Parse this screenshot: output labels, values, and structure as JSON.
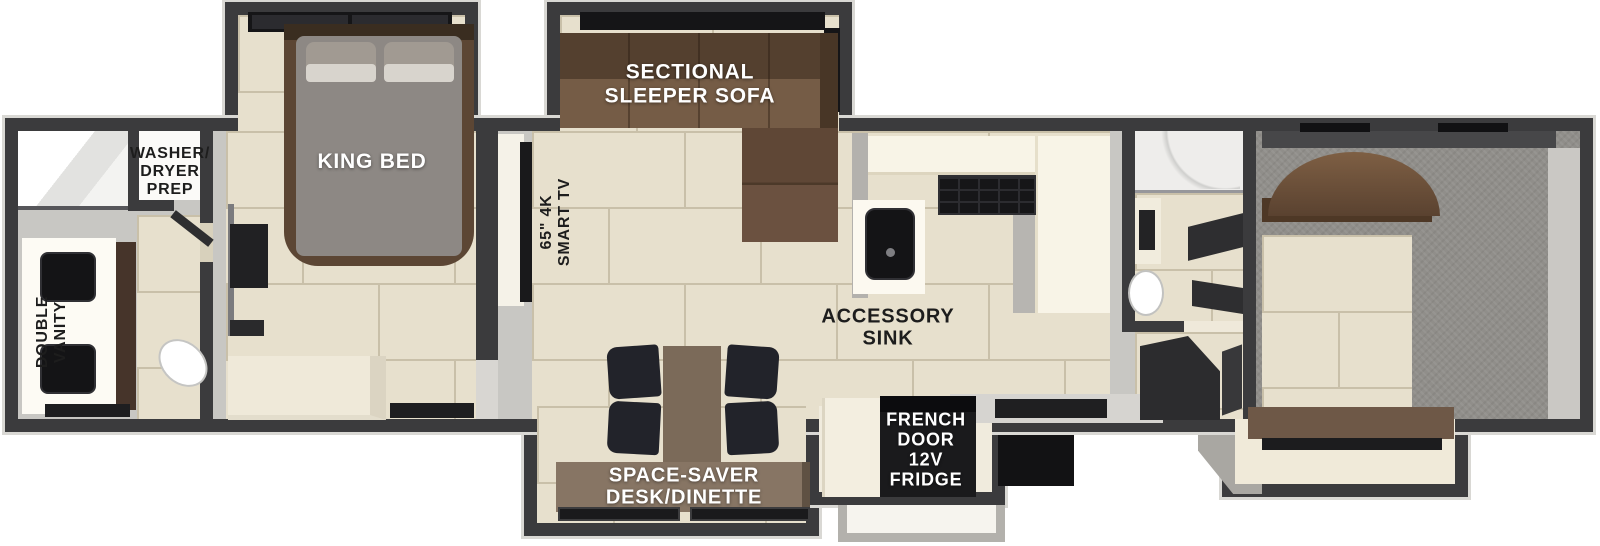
{
  "labels": {
    "washer_dryer": "WASHER/\nDRYER\nPREP",
    "double_vanity": "DOUBLE\nVANITY",
    "king_bed": "KING BED",
    "smart_tv": "65\" 4K\nSMART TV",
    "sectional": "SECTIONAL\nSLEEPER SOFA",
    "accessory_sink": "ACCESSORY\nSINK",
    "desk_dinette": "SPACE-SAVER\nDESK/DINETTE",
    "fridge": "FRENCH\nDOOR\n12V\nFRIDGE"
  },
  "colors": {
    "wall": "#3b3b3d",
    "floor": "#c8c7c3",
    "tile": "#e7e0cd",
    "grout": "#c9c0a9",
    "counter_cream": "#f8f4e7",
    "sofa_brown": "#6b5140",
    "wood_brown": "#6e5847",
    "appliance_black": "#1a1a1c",
    "garage_gray": "#908e8a",
    "step_gray": "#b3b1ac",
    "label_dark": "#1d1d1d",
    "label_light": "#ffffff"
  }
}
